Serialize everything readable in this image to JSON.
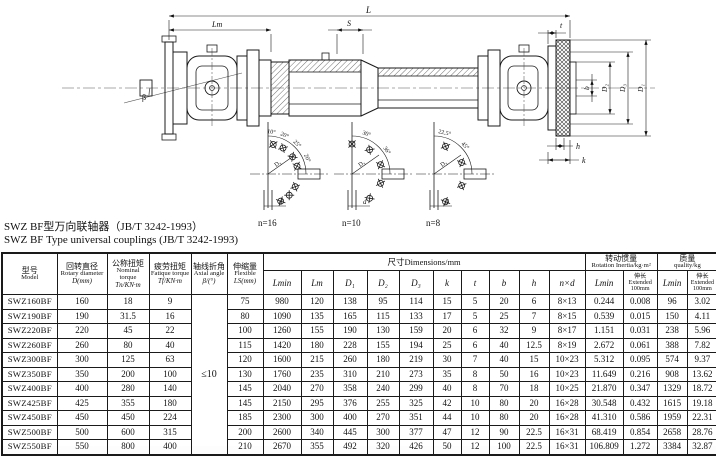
{
  "titles": {
    "cn": "SWZ BF型万向联轴器（JB/T 3242-1993）",
    "en": "SWZ BF Type universal couplings (JB/T 3242-1993)"
  },
  "drawing": {
    "labels": {
      "L": "L",
      "Lm": "Lm",
      "S": "S",
      "t": "t",
      "b": "b",
      "D2": "D₂",
      "D3": "D₃",
      "D1": "D₁",
      "h": "h",
      "k": "k",
      "beta": "β"
    },
    "bolt_diagrams": [
      {
        "label": "n=16",
        "angles": [
          "10°",
          "20°",
          "25°",
          "20°"
        ],
        "circle_label": "D₃",
        "hole_dia_label": "d"
      },
      {
        "label": "n=10",
        "angles": [
          "30°",
          "36°"
        ],
        "circle_label": "D₃",
        "hole_dia_label": "d"
      },
      {
        "label": "n=8",
        "angles": [
          "22.5°",
          "45°"
        ],
        "circle_label": "D₃",
        "hole_dia_label": "d"
      }
    ]
  },
  "table": {
    "headers": {
      "model": {
        "cn": "型号",
        "en": "Model"
      },
      "rotary": {
        "cn": "回转直径",
        "en": "Rotary diameter",
        "sym": "D(mm)"
      },
      "nominal": {
        "cn": "公称扭矩",
        "en": "Nominal torque",
        "sym": "Tn/KN·m"
      },
      "fatigue": {
        "cn": "疲劳扭矩",
        "en": "Fatique torque",
        "sym": "Tf/KN·m"
      },
      "axial": {
        "cn": "轴线折角",
        "en": "Axial angle",
        "sym": "β/(°)"
      },
      "flexible": {
        "cn": "伸缩量",
        "en": "Flexible",
        "sym": "LS(mm)"
      },
      "dimensions": "尺寸Dimensions/mm",
      "inertia": {
        "cn": "转动惯量",
        "en": "Rotation Inertia/kg·m²"
      },
      "quality": {
        "cn": "质量",
        "en": "quality/kg"
      },
      "dim_cols": [
        "Lmin",
        "Lm",
        "D₁",
        "D₂",
        "D₃",
        "k",
        "t",
        "b",
        "h",
        "n×d"
      ],
      "sub_lmin": "Lmin",
      "sub_ext": {
        "cn": "伸长",
        "en": "Extended",
        "val": "100mm"
      }
    },
    "axial_angle_value": "≤10",
    "rows": [
      [
        "SWZ160BF",
        "160",
        "18",
        "9",
        "75",
        "980",
        "120",
        "138",
        "95",
        "114",
        "15",
        "5",
        "20",
        "6",
        "8×13",
        "0.244",
        "0.008",
        "96",
        "3.02"
      ],
      [
        "SWZ190BF",
        "190",
        "31.5",
        "16",
        "80",
        "1090",
        "135",
        "165",
        "115",
        "133",
        "17",
        "5",
        "25",
        "7",
        "8×15",
        "0.539",
        "0.015",
        "150",
        "4.11"
      ],
      [
        "SWZ220BF",
        "220",
        "45",
        "22",
        "100",
        "1260",
        "155",
        "190",
        "130",
        "159",
        "20",
        "6",
        "32",
        "9",
        "8×17",
        "1.151",
        "0.031",
        "238",
        "5.96"
      ],
      [
        "SWZ260BF",
        "260",
        "80",
        "40",
        "115",
        "1420",
        "180",
        "228",
        "155",
        "194",
        "25",
        "6",
        "40",
        "12.5",
        "8×19",
        "2.672",
        "0.061",
        "388",
        "7.82"
      ],
      [
        "SWZ300BF",
        "300",
        "125",
        "63",
        "120",
        "1600",
        "215",
        "260",
        "180",
        "219",
        "30",
        "7",
        "40",
        "15",
        "10×23",
        "5.312",
        "0.095",
        "574",
        "9.37"
      ],
      [
        "SWZ350BF",
        "350",
        "200",
        "100",
        "130",
        "1760",
        "235",
        "310",
        "210",
        "273",
        "35",
        "8",
        "50",
        "16",
        "10×23",
        "11.649",
        "0.216",
        "908",
        "13.62"
      ],
      [
        "SWZ400BF",
        "400",
        "280",
        "140",
        "145",
        "2040",
        "270",
        "358",
        "240",
        "299",
        "40",
        "8",
        "70",
        "18",
        "10×25",
        "21.870",
        "0.347",
        "1329",
        "18.72"
      ],
      [
        "SWZ425BF",
        "425",
        "355",
        "180",
        "145",
        "2150",
        "295",
        "376",
        "255",
        "325",
        "42",
        "10",
        "80",
        "20",
        "16×28",
        "30.548",
        "0.432",
        "1615",
        "19.18"
      ],
      [
        "SWZ450BF",
        "450",
        "450",
        "224",
        "185",
        "2300",
        "300",
        "400",
        "270",
        "351",
        "44",
        "10",
        "80",
        "20",
        "16×28",
        "41.310",
        "0.586",
        "1959",
        "22.31"
      ],
      [
        "SWZ500BF",
        "500",
        "600",
        "315",
        "200",
        "2600",
        "340",
        "445",
        "300",
        "377",
        "47",
        "12",
        "90",
        "22.5",
        "16×31",
        "68.419",
        "0.854",
        "2658",
        "28.76"
      ],
      [
        "SWZ550BF",
        "550",
        "800",
        "400",
        "210",
        "2670",
        "355",
        "492",
        "320",
        "426",
        "50",
        "12",
        "100",
        "22.5",
        "16×31",
        "106.809",
        "1.272",
        "3384",
        "32.87"
      ]
    ]
  }
}
